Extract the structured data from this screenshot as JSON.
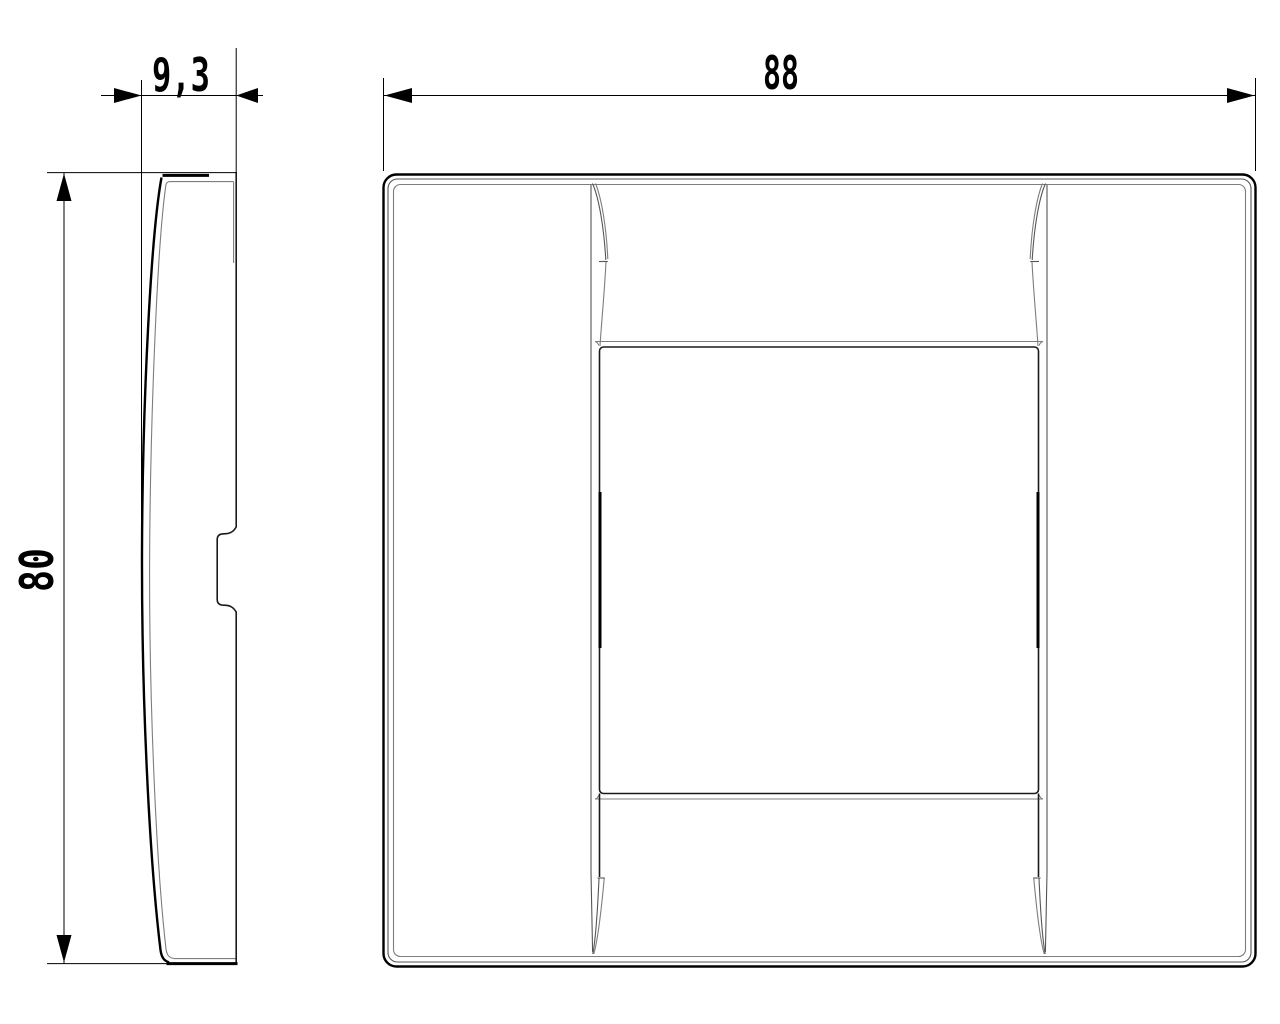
{
  "drawing": {
    "background": "#ffffff",
    "primary_line_color": "#000000",
    "secondary_line_color": "#7d7d7d",
    "dimensions": {
      "depth": {
        "value": "9,3"
      },
      "width": {
        "value": "88"
      },
      "height": {
        "value": "80"
      }
    }
  }
}
